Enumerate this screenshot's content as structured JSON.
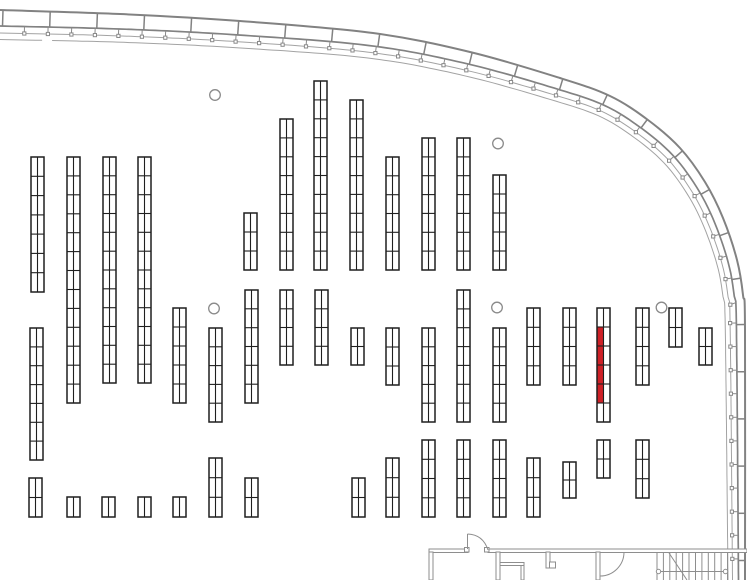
{
  "app": {
    "name": "store-floor-plan-viewer"
  },
  "canvas": {
    "width": 747,
    "height": 580,
    "background": "#ffffff"
  },
  "colors": {
    "rack_stroke": "#1f1f1f",
    "rack_fill": "#ffffff",
    "highlight": "#ce2127",
    "perimeter_thick": "#828282",
    "perimeter_thin": "#a3a3a3",
    "interior_wall": "#8e8e8e",
    "pillar": "#8a8a8a"
  },
  "rack_width": 13,
  "racks": [
    {
      "x": 31,
      "y": 157,
      "h": 135,
      "s": 7
    },
    {
      "x": 67,
      "y": 157,
      "h": 246,
      "s": 13
    },
    {
      "x": 103,
      "y": 157,
      "h": 226,
      "s": 12
    },
    {
      "x": 138,
      "y": 157,
      "h": 226,
      "s": 12
    },
    {
      "x": 244,
      "y": 213,
      "h": 57,
      "s": 3
    },
    {
      "x": 280,
      "y": 119,
      "h": 151,
      "s": 8
    },
    {
      "x": 314,
      "y": 81,
      "h": 189,
      "s": 10
    },
    {
      "x": 350,
      "y": 100,
      "h": 170,
      "s": 9
    },
    {
      "x": 386,
      "y": 157,
      "h": 113,
      "s": 6
    },
    {
      "x": 422,
      "y": 138,
      "h": 132,
      "s": 7
    },
    {
      "x": 457,
      "y": 138,
      "h": 132,
      "s": 7
    },
    {
      "x": 493,
      "y": 175,
      "h": 95,
      "s": 5
    },
    {
      "x": 30,
      "y": 328,
      "h": 132,
      "s": 7
    },
    {
      "x": 173,
      "y": 308,
      "h": 95,
      "s": 5
    },
    {
      "x": 209,
      "y": 328,
      "h": 94,
      "s": 5
    },
    {
      "x": 245,
      "y": 290,
      "h": 113,
      "s": 6
    },
    {
      "x": 280,
      "y": 290,
      "h": 75,
      "s": 4
    },
    {
      "x": 315,
      "y": 290,
      "h": 75,
      "s": 4
    },
    {
      "x": 351,
      "y": 328,
      "h": 37,
      "s": 2
    },
    {
      "x": 386,
      "y": 328,
      "h": 57,
      "s": 3
    },
    {
      "x": 422,
      "y": 328,
      "h": 94,
      "s": 5
    },
    {
      "x": 457,
      "y": 290,
      "h": 132,
      "s": 7
    },
    {
      "x": 493,
      "y": 328,
      "h": 94,
      "s": 5
    },
    {
      "x": 527,
      "y": 308,
      "h": 77,
      "s": 4
    },
    {
      "x": 563,
      "y": 308,
      "h": 77,
      "s": 4
    },
    {
      "x": 597,
      "y": 308,
      "h": 114,
      "s": 6,
      "hl": {
        "side": "left",
        "from": 1,
        "to": 4
      }
    },
    {
      "x": 636,
      "y": 308,
      "h": 77,
      "s": 4
    },
    {
      "x": 669,
      "y": 308,
      "h": 39,
      "s": 2
    },
    {
      "x": 699,
      "y": 328,
      "h": 37,
      "s": 2
    },
    {
      "x": 29,
      "y": 478,
      "h": 39,
      "s": 2
    },
    {
      "x": 67,
      "y": 497,
      "h": 20,
      "s": 1
    },
    {
      "x": 102,
      "y": 497,
      "h": 20,
      "s": 1
    },
    {
      "x": 138,
      "y": 497,
      "h": 20,
      "s": 1
    },
    {
      "x": 173,
      "y": 497,
      "h": 20,
      "s": 1
    },
    {
      "x": 209,
      "y": 458,
      "h": 59,
      "s": 3
    },
    {
      "x": 245,
      "y": 478,
      "h": 39,
      "s": 2
    },
    {
      "x": 352,
      "y": 478,
      "h": 39,
      "s": 2
    },
    {
      "x": 386,
      "y": 458,
      "h": 59,
      "s": 3
    },
    {
      "x": 422,
      "y": 440,
      "h": 77,
      "s": 4
    },
    {
      "x": 457,
      "y": 440,
      "h": 77,
      "s": 4
    },
    {
      "x": 493,
      "y": 440,
      "h": 77,
      "s": 4
    },
    {
      "x": 527,
      "y": 458,
      "h": 59,
      "s": 3
    },
    {
      "x": 563,
      "y": 462,
      "h": 36,
      "s": 2
    },
    {
      "x": 597,
      "y": 440,
      "h": 38,
      "s": 2
    },
    {
      "x": 636,
      "y": 440,
      "h": 58,
      "s": 3
    }
  ],
  "pillars": {
    "r": 5.3,
    "centers": [
      [
        215,
        95
      ],
      [
        498,
        143.5
      ],
      [
        214,
        308.5
      ],
      [
        497,
        307.5
      ],
      [
        661.5,
        307.5
      ]
    ]
  },
  "perimeter": {
    "outer_points": [
      [
        0,
        10
      ],
      [
        120,
        14
      ],
      [
        240,
        21
      ],
      [
        373,
        33
      ],
      [
        470,
        52
      ],
      [
        560,
        78
      ],
      [
        610,
        96
      ],
      [
        648,
        120
      ],
      [
        680,
        148
      ],
      [
        705,
        182
      ],
      [
        723,
        218
      ],
      [
        737,
        260
      ],
      [
        743,
        295
      ],
      [
        745,
        330
      ],
      [
        745,
        580
      ]
    ],
    "offsets_inner_wall": {
      "start": 16,
      "end": 6.5
    },
    "offsets_tick_line": {
      "start": 23,
      "end": 12.5
    },
    "offsets_inner_line": {
      "start": 29.5,
      "end": 17
    },
    "divider": {
      "start": 3,
      "spacing": 47.2
    },
    "ticks": {
      "start": 25,
      "spacing": 23.6,
      "square": 3.2
    },
    "inner_line_gap": [
      43,
      53
    ]
  },
  "bottom": {
    "wall": {
      "y": 549,
      "h": 3.5,
      "segments": [
        [
          429,
          468
        ],
        [
          488,
          747
        ]
      ]
    },
    "door_jambs": [
      {
        "x": 464.5,
        "y": 547.5,
        "w": 4.5,
        "h": 4.5
      },
      {
        "x": 484.5,
        "y": 547.5,
        "w": 4.5,
        "h": 4.5
      }
    ],
    "door_main_leaf": {
      "x1": 467.5,
      "y1": 549,
      "x2": 467.5,
      "y2": 534
    },
    "door_main_arc": "M467.5,534 Q483,534.5 488,550",
    "door_inner_arc": "M624,552 A24,24 0 0 1 600,576",
    "partitions": [
      {
        "x": 429,
        "y": 552,
        "w": 4,
        "h": 28
      },
      {
        "x": 496,
        "y": 552,
        "w": 4,
        "h": 28
      },
      {
        "x": 546,
        "y": 552,
        "w": 4,
        "h": 16
      },
      {
        "x": 596,
        "y": 552,
        "w": 4,
        "h": 28
      }
    ],
    "counters": [
      {
        "x": 500,
        "y": 562.5,
        "w": 24,
        "h": 3
      },
      {
        "x": 521,
        "y": 565.5,
        "w": 3,
        "h": 14.5
      },
      {
        "x": 549.5,
        "y": 562,
        "w": 6,
        "h": 6
      }
    ],
    "stairs": {
      "x1": 657,
      "x2": 727.5,
      "y1": 552.5,
      "y2": 580,
      "steps": 12,
      "diag": [
        669,
        553,
        687,
        580
      ],
      "arrow": {
        "y": 571.5,
        "x1": 658.5,
        "x2": 725.5,
        "r": 2.2
      }
    }
  }
}
